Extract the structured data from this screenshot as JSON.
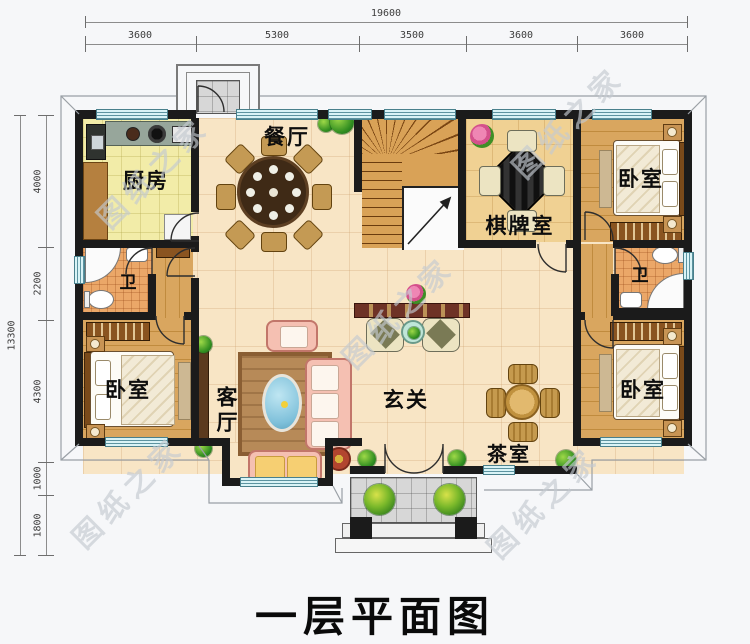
{
  "title": "一层平面图",
  "watermark_text": "图纸之家",
  "dimensions": {
    "top": {
      "total": "19600",
      "segments": [
        "3600",
        "5300",
        "3500",
        "3600",
        "3600"
      ]
    },
    "left": {
      "total": "13300",
      "segments": [
        "4000",
        "2200",
        "4300",
        "1000",
        "1800"
      ]
    }
  },
  "rooms": {
    "kitchen": {
      "label": "厨房"
    },
    "dining": {
      "label": "餐厅"
    },
    "chess_room": {
      "label": "棋牌室"
    },
    "bedroom_top_right": {
      "label": "卧室"
    },
    "bath_left": {
      "label": "卫"
    },
    "bath_right": {
      "label": "卫"
    },
    "bedroom_bottom_left": {
      "label": "卧室"
    },
    "living_room": {
      "label": "客厅"
    },
    "foyer": {
      "label": "玄关"
    },
    "tea_room": {
      "label": "茶室"
    },
    "bedroom_bottom_right": {
      "label": "卧室"
    }
  },
  "colors": {
    "wall": "#1b1b1b",
    "window": "#d9f3f6",
    "floor_tile": "#f8e5c5",
    "wood": "#d9a65f",
    "kitchen_floor": "#f2eca8",
    "bath_floor": "#eba768",
    "sofa": "#f5c0b2",
    "watermark": "#c4cad1"
  }
}
